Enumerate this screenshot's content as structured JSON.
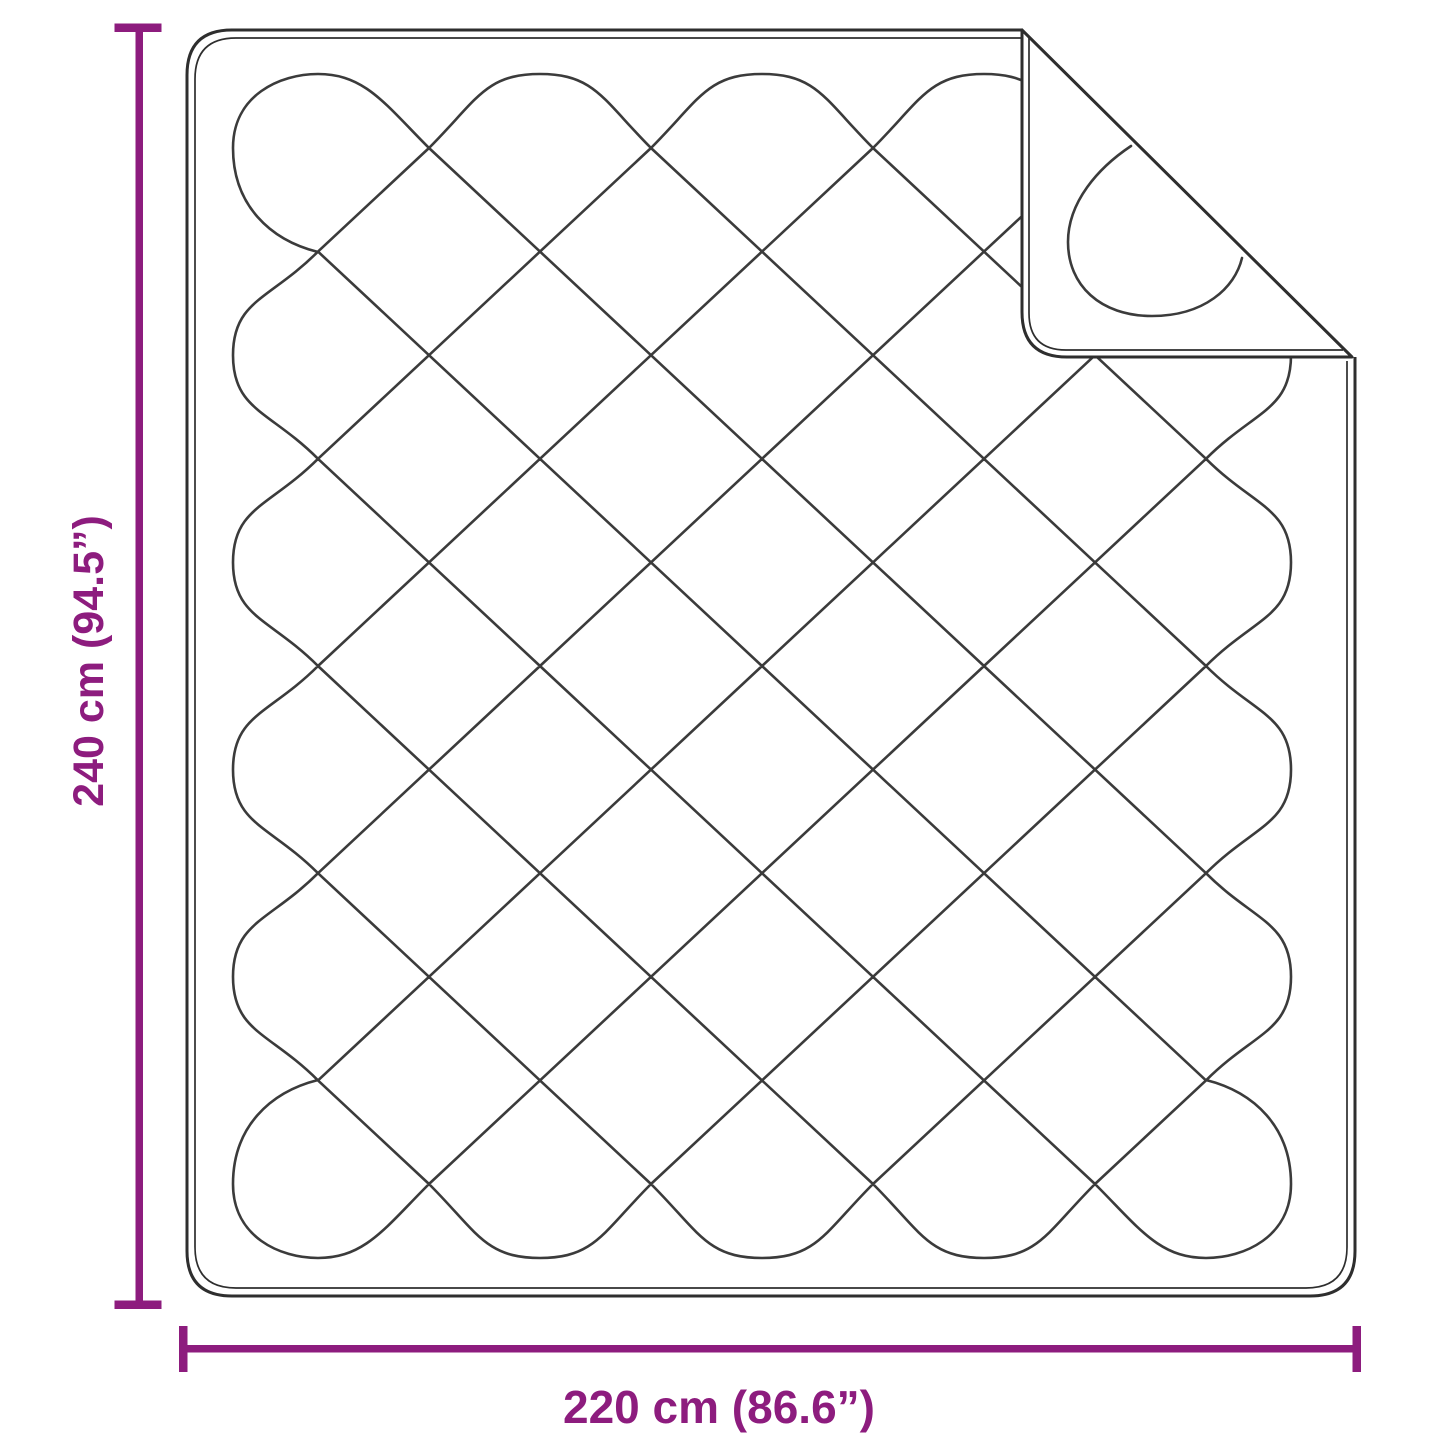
{
  "diagram": {
    "height_dimension": {
      "label": "240 cm (94.5”)",
      "value_cm": 240,
      "value_inches": 94.5
    },
    "width_dimension": {
      "label": "220 cm (86.6”)",
      "value_cm": 220,
      "value_inches": 86.6
    },
    "colors": {
      "dimension_accent": "#8d1c7e",
      "stitch_line": "#3b3b3b",
      "border_line": "#2e2e2e",
      "background": "#ffffff",
      "blanket_fill": "#ffffff"
    }
  }
}
